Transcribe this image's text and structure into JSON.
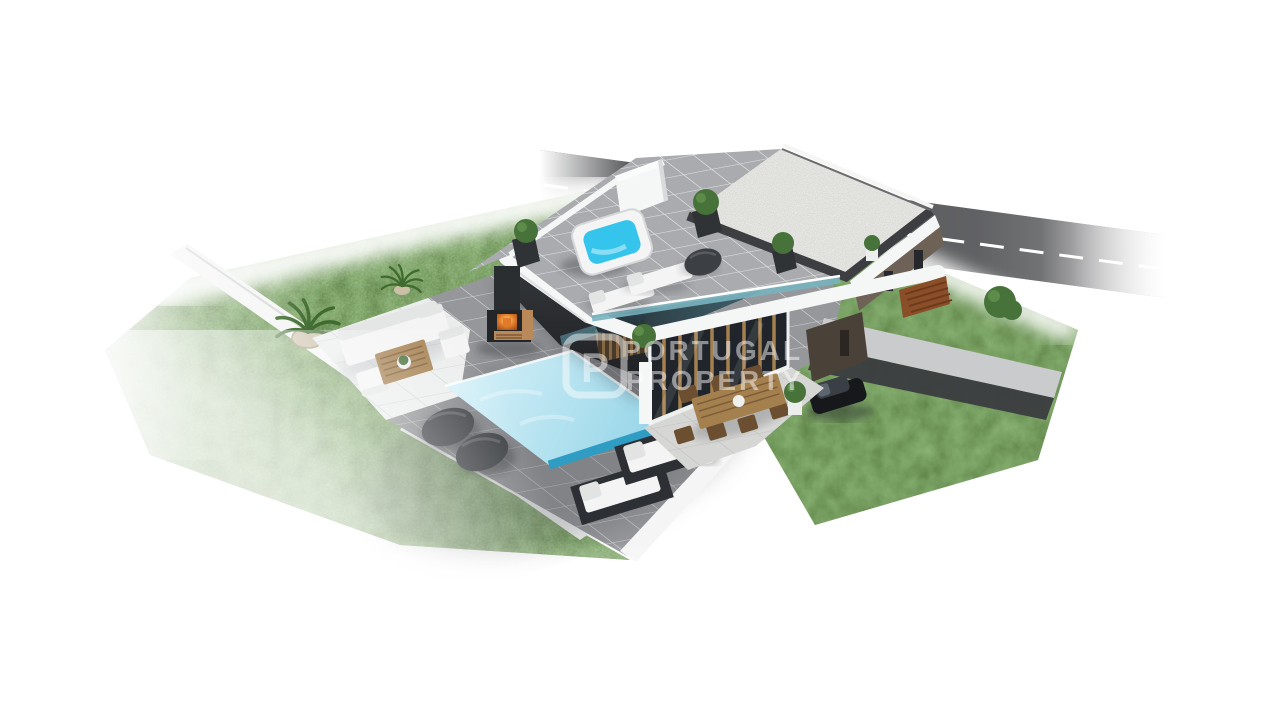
{
  "watermark": {
    "logo_letter": "P",
    "line1": "PORTUGAL",
    "line2": "PROPERTY",
    "color": "#ffffff"
  },
  "scene": {
    "colors": {
      "background": "#ffffff",
      "road_asphalt": "#4b4c4f",
      "road_marking": "#ffffff",
      "lawn_green": "#5d8045",
      "terrace_tile_gray": "#96979a",
      "roof_tile_gray": "#a9abae",
      "patio_pale": "#eceded",
      "boundary_wall_white": "#f4f5f4",
      "fascia_white": "#f5f6f6",
      "gravel_white": "#eae9e4",
      "gravel_frame_dark": "#3c3e41",
      "pool_water_blue": "#aee0f0",
      "pool_edge_deep": "#2f9dc3",
      "hot_tub_blue": "#35c4ec",
      "glass_teal": "#79b3bf",
      "upper_wall_brown": "#6e6257",
      "garage_wall_brown": "#4a4138",
      "gate_corten": "#8a4e28",
      "bush_green": "#47723a",
      "palm_green": "#3f6b2f",
      "pot_sand": "#cbbfa8",
      "wood_warm": "#a5804f",
      "wood_dark": "#6b4f30",
      "log_brown": "#b9895a",
      "fire_orange": "#e27a2b",
      "furniture_white": "#f3f4f3",
      "dark_fabric": "#3c3f43",
      "concrete_light": "#cacbcd",
      "car_black": "#17181b"
    }
  }
}
